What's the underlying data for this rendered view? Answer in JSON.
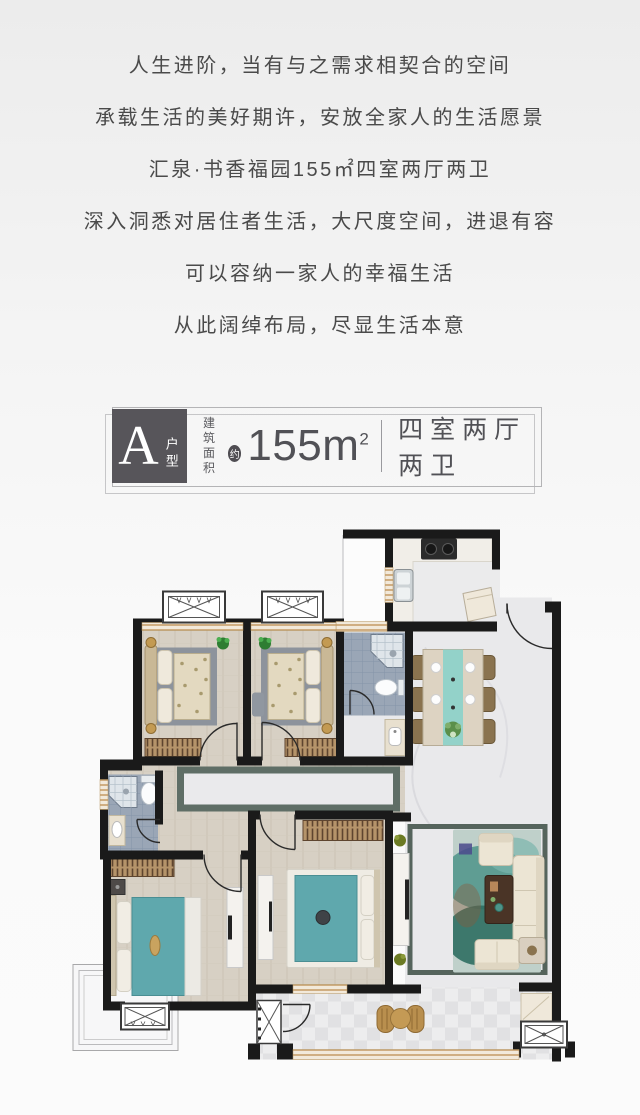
{
  "page": {
    "background_top": "#ececec",
    "background_bottom": "#fbfbfb"
  },
  "headline": {
    "text_color": "#4a4a4a",
    "lines": [
      "人生进阶，当有与之需求相契合的空间",
      "承载生活的美好期许，安放全家人的生活愿景",
      "汇泉·书香福园155㎡四室两厅两卫",
      "深入洞悉对居住者生活，大尺度空间，进退有容",
      "可以容纳一家人的幸福生活",
      "从此阔绰布局，尽显生活本意"
    ]
  },
  "unit_badge": {
    "letter": "A",
    "letter_label": "户型",
    "area_label_top": "建筑",
    "area_label_bottom": "面积",
    "approx_mark": "约",
    "area_value": "155m",
    "area_superscript": "2",
    "layout_text": "四室两厅两卫",
    "box_color": "#57555a",
    "text_color": "#515156",
    "frame_color": "#b4b4b6"
  },
  "floor_plan": {
    "palette": {
      "wall": "#1a1a1a",
      "wood_floor": "#d7d0c4",
      "marble_floor": "#e9e9eb",
      "bath_tile": "#9aa6b6",
      "bed_teal": "#5fa8ad",
      "rug_teal": "#4d948a",
      "dining_runner": "#93d2c9",
      "furniture_beige": "#ece5d4",
      "cabinet_wood": "#b5946a",
      "rattan_gold": "#b98f4e",
      "window_sill": "#c8a06c",
      "rug_border": "#5f6e66",
      "gold_accent": "#c39a52"
    }
  }
}
